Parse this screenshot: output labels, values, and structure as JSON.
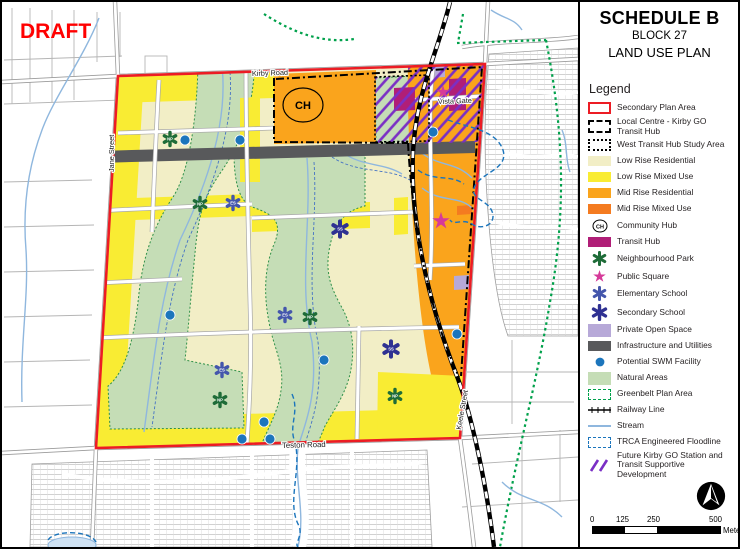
{
  "draft_label": "DRAFT",
  "title": {
    "schedule": "SCHEDULE B",
    "block": "BLOCK 27",
    "plan": "LAND USE PLAN"
  },
  "legend": {
    "heading": "Legend",
    "items": [
      {
        "id": "secondary-plan-area",
        "label": "Secondary Plan Area"
      },
      {
        "id": "local-centre",
        "label": "Local Centre - Kirby GO",
        "label2": "Transit Hub"
      },
      {
        "id": "west-transit-hub-study-area",
        "label": "West Transit Hub Study Area"
      },
      {
        "id": "low-rise-residential",
        "label": "Low Rise Residential"
      },
      {
        "id": "low-rise-mixed-use",
        "label": "Low Rise Mixed Use"
      },
      {
        "id": "mid-rise-residential",
        "label": "Mid Rise Residential"
      },
      {
        "id": "mid-rise-mixed-use",
        "label": "Mid Rise Mixed Use"
      },
      {
        "id": "community-hub",
        "label": "Community Hub"
      },
      {
        "id": "transit-hub",
        "label": "Transit Hub"
      },
      {
        "id": "neighbourhood-park",
        "label": "Neighbourhood Park"
      },
      {
        "id": "public-square",
        "label": "Public Square"
      },
      {
        "id": "elementary-school",
        "label": "Elementary School"
      },
      {
        "id": "secondary-school",
        "label": "Secondary School"
      },
      {
        "id": "private-open-space",
        "label": "Private Open Space"
      },
      {
        "id": "infrastructure-utilities",
        "label": "Infrastructure and Utilities"
      },
      {
        "id": "potential-swm-facility",
        "label": "Potential SWM Facility"
      },
      {
        "id": "natural-areas",
        "label": "Natural Areas"
      },
      {
        "id": "greenbelt-plan-area",
        "label": "Greenbelt Plan Area"
      },
      {
        "id": "railway-line",
        "label": "Railway Line"
      },
      {
        "id": "stream",
        "label": "Stream"
      },
      {
        "id": "trca-floodline",
        "label": "TRCA Engineered Floodline"
      },
      {
        "id": "future-kirby-go",
        "label": "Future Kirby GO Station and",
        "label2": "Transit Supportive Development"
      }
    ]
  },
  "map_labels": {
    "kirby_road": "Kirby Road",
    "jane_street": "Jane Street",
    "teston_road": "Teston Road",
    "keele_street": "Keele Street",
    "vista_gate": "Vista Gate",
    "community_hub": "CH"
  },
  "symbol_letters": {
    "np": "NP",
    "es": "ES",
    "ss": "SS"
  },
  "scale_bar": {
    "ticks": [
      "0",
      "125",
      "250",
      "500"
    ],
    "unit": "Meters"
  },
  "colors": {
    "secondary_plan_boundary": "#EC1C24",
    "low_rise_residential": "#F2EEC6",
    "low_rise_mixed_use": "#F9EC33",
    "mid_rise_residential": "#FAA41C",
    "mid_rise_mixed_use": "#F47B20",
    "transit_hub": "#B01E77",
    "public_square": "#D63A99",
    "neighbourhood_park": "#1E6C38",
    "elementary_school": "#4456AC",
    "secondary_school": "#2F3192",
    "private_open_space": "#B7A9D8",
    "infrastructure": "#58595B",
    "swm_facility": "#1C75BC",
    "natural_areas": "#C5DDB6",
    "greenbelt": "#00A14B",
    "railway": "#000000",
    "stream": "#8FB7DE",
    "trca_floodline": "#1B75BC",
    "future_go_hatch": "#7A2FC5",
    "draft_text": "#FF0000"
  }
}
